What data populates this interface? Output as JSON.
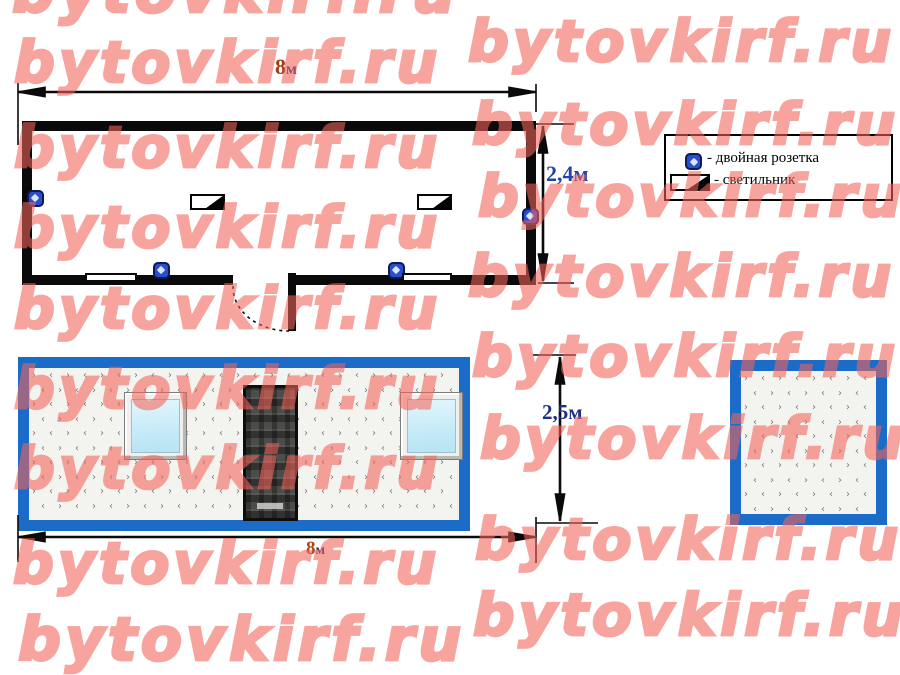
{
  "watermark": {
    "text": "bytovkirf.ru",
    "color": "#f4645a",
    "opacity": 0.58,
    "instances": [
      {
        "x": 12,
        "y": -38,
        "size": 60
      },
      {
        "x": 14,
        "y": 35,
        "size": 57
      },
      {
        "x": 14,
        "y": 120,
        "size": 57
      },
      {
        "x": 14,
        "y": 200,
        "size": 57
      },
      {
        "x": 14,
        "y": 281,
        "size": 57
      },
      {
        "x": 14,
        "y": 361,
        "size": 57
      },
      {
        "x": 14,
        "y": 441,
        "size": 57
      },
      {
        "x": 13,
        "y": 536,
        "size": 57
      },
      {
        "x": 18,
        "y": 610,
        "size": 60
      },
      {
        "x": 468,
        "y": 14,
        "size": 57
      },
      {
        "x": 472,
        "y": 97,
        "size": 57
      },
      {
        "x": 478,
        "y": 169,
        "size": 57
      },
      {
        "x": 468,
        "y": 249,
        "size": 57
      },
      {
        "x": 472,
        "y": 329,
        "size": 57
      },
      {
        "x": 480,
        "y": 411,
        "size": 57
      },
      {
        "x": 475,
        "y": 512,
        "size": 57
      },
      {
        "x": 473,
        "y": 586,
        "size": 58
      }
    ]
  },
  "plan": {
    "width_dim": {
      "value": "8",
      "unit": "м"
    },
    "height_dim": "2,4м",
    "sockets": [
      {
        "x": 35,
        "y": 198
      },
      {
        "x": 530,
        "y": 216
      },
      {
        "x": 161,
        "y": 270
      },
      {
        "x": 396,
        "y": 270
      }
    ],
    "lights": [
      {
        "x": 190,
        "y": 194
      },
      {
        "x": 417,
        "y": 194
      }
    ],
    "wall_windows": [
      {
        "x": 85,
        "y": 273,
        "w": 52
      },
      {
        "x": 402,
        "y": 273,
        "w": 50
      }
    ]
  },
  "legend": {
    "items": [
      {
        "icon": "double-socket-icon",
        "label": "- двойная розетка"
      },
      {
        "icon": "ceiling-light-icon",
        "label": "- светильник"
      }
    ]
  },
  "front_elevation": {
    "width_dim": {
      "value": "8",
      "unit": "м"
    },
    "height_dim": "2,5м"
  },
  "colors": {
    "frame_blue": "#1a6cc8",
    "wall_black": "#0a0a0a",
    "dim_blue": "#2444aa",
    "dim_navy": "#1e2f88",
    "dim_red": "#a23a12",
    "glass": "#c5eaf8",
    "watermark": "#f4645a"
  }
}
